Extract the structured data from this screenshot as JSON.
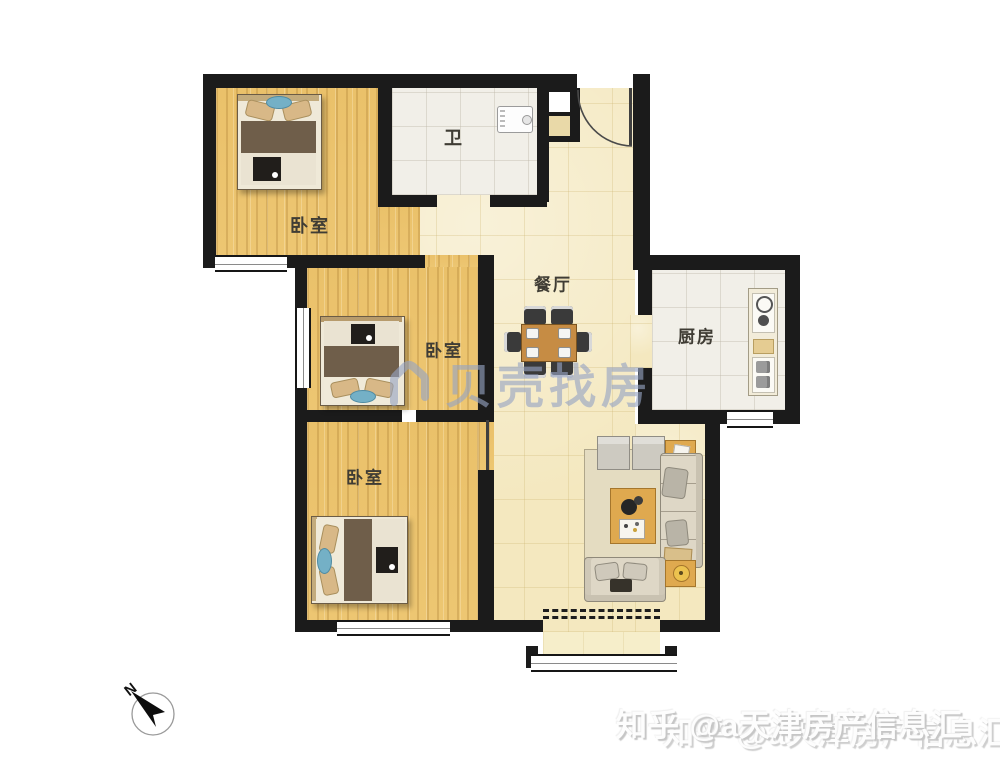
{
  "rooms": {
    "bedroom_top_left": {
      "label": "卧室"
    },
    "bathroom": {
      "label": "卫"
    },
    "dining": {
      "label": "餐厅"
    },
    "kitchen": {
      "label": "厨房"
    },
    "bedroom_middle": {
      "label": "卧室"
    },
    "bedroom_bottom": {
      "label": "卧室"
    }
  },
  "watermarks": {
    "brand": {
      "text": "贝壳找房",
      "color": "#96a4c4"
    },
    "zhihu": {
      "text": "知乎 @a天津房产信息汇",
      "color": "#ffffff"
    }
  },
  "compass": {
    "label": "N"
  },
  "colors": {
    "wall": "#1b1b1b",
    "wood_floor": "#eac26c",
    "hall_floor": "#f4e8bf",
    "tile_floor": "#f1efe8",
    "balcony_floor": "#f6eeca",
    "furniture_tan": "#dfa94f",
    "sofa_cream": "#ded7c6",
    "blanket_brown": "#6f5e4a",
    "accent_teal": "#74b0c6"
  }
}
